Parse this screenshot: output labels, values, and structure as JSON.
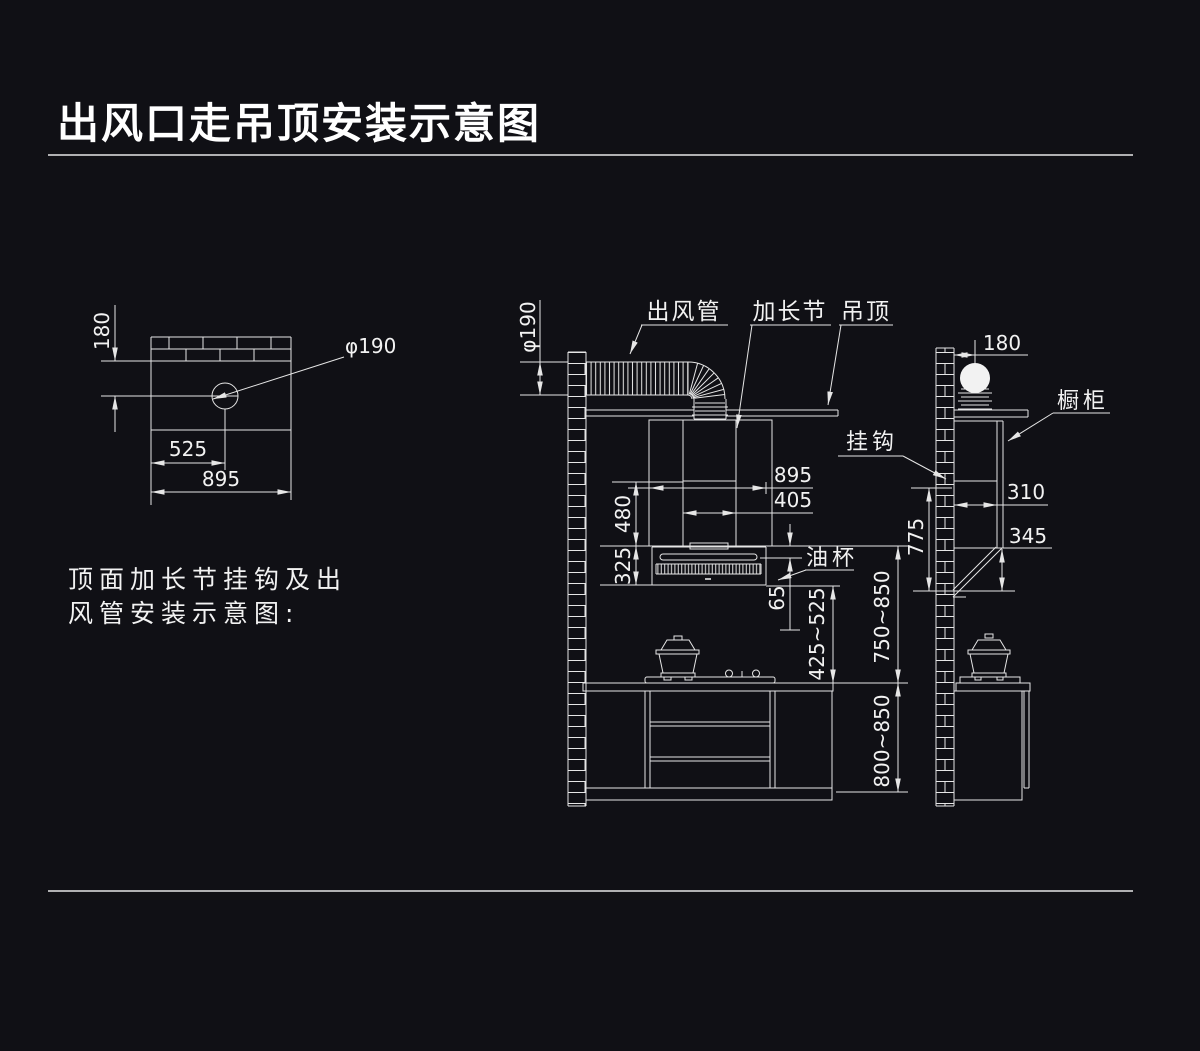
{
  "colors": {
    "background": "#101015",
    "line": "#e6e6e6",
    "text": "#f2f2f2",
    "title": "#ffffff"
  },
  "title": "出风口走吊顶安装示意图",
  "caption": {
    "line1": "顶面加长节挂钩及出",
    "line2": "风管安装示意图:"
  },
  "left_view": {
    "dims": {
      "beam_to_hole_center": "180",
      "hole_diameter": "φ190",
      "hole_center_offset": "525",
      "overall_width": "895"
    }
  },
  "main_view": {
    "labels": {
      "air_duct": "出风管",
      "extension_section": "加长节",
      "suspended_ceiling": "吊顶",
      "oil_cup": "油杯"
    },
    "dims": {
      "duct_diameter": "φ190",
      "hood_width": "895",
      "outlet_width": "405",
      "extension_height": "480",
      "hood_body_height": "325",
      "top_gap": "65",
      "hood_bottom_to_counter": "425~525",
      "hood_top_to_counter": "750~850",
      "counter_height": "800~850"
    }
  },
  "side_view": {
    "labels": {
      "hook": "挂钩",
      "cabinet": "橱柜"
    },
    "dims": {
      "wall_to_duct_center": "180",
      "cabinet_depth": "310",
      "lower_section_height": "345",
      "hook_to_hood_bottom": "775"
    }
  }
}
